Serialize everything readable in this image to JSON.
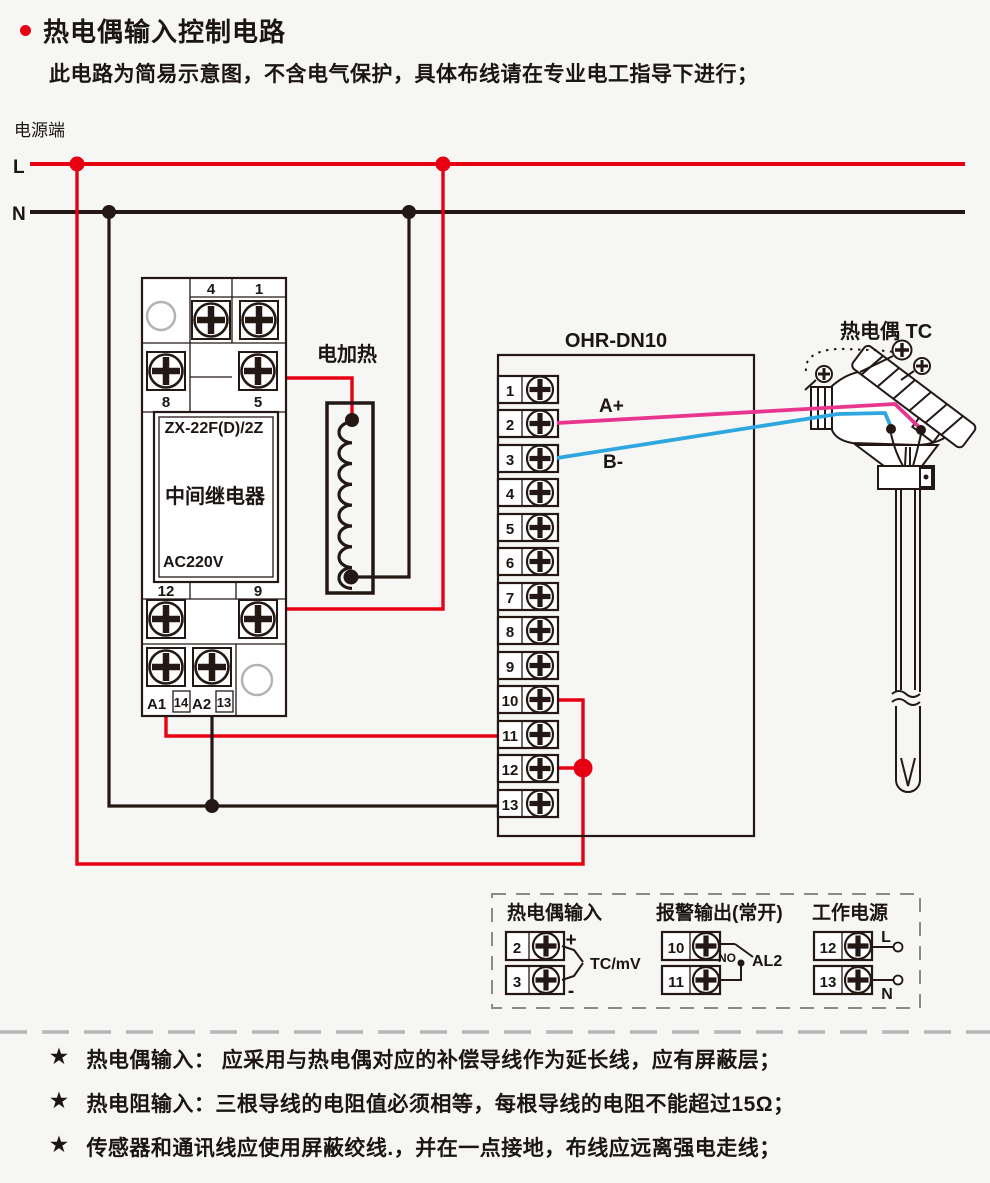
{
  "colors": {
    "line_red": "#e60012",
    "line_black": "#231815",
    "wire_pink": "#e8368f",
    "wire_blue": "#2ea7e0",
    "dash_gray": "#b5b5b6"
  },
  "header": {
    "title": "热电偶输入控制电路",
    "subtitle": "此电路为简易示意图，不含电气保护，具体布线请在专业电工指导下进行；"
  },
  "power": {
    "label": "电源端",
    "live": "L",
    "neutral": "N"
  },
  "relay": {
    "model": "ZX-22F(D)/2Z",
    "name": "中间继电器",
    "voltage": "AC220V",
    "top_terminals": [
      "4",
      "1"
    ],
    "row2_terminals": [
      "8",
      "5"
    ],
    "mid_terminals": [
      "12",
      "9"
    ],
    "coil_terminals": [
      "A1",
      "14",
      "A2",
      "13"
    ]
  },
  "heater": {
    "label": "电加热"
  },
  "controller": {
    "title": "OHR-DN10",
    "terminals": [
      "1",
      "2",
      "3",
      "4",
      "5",
      "6",
      "7",
      "8",
      "9",
      "10",
      "11",
      "12",
      "13"
    ],
    "a_plus": "A+",
    "b_minus": "B-"
  },
  "thermocouple": {
    "label": "热电偶 TC"
  },
  "legend": {
    "tc_input": {
      "title": "热电偶输入",
      "t2": "2",
      "t3": "3",
      "plus": "+",
      "minus": "-",
      "signal": "TC/mV"
    },
    "alarm": {
      "title": "报警输出(常开)",
      "t10": "10",
      "t11": "11",
      "no": "NO",
      "name": "AL2"
    },
    "supply": {
      "title": "工作电源",
      "t12": "12",
      "t13": "13",
      "live": "L",
      "neutral": "N"
    }
  },
  "notes": {
    "star": "★",
    "items": [
      "热电偶输入： 应采用与热电偶对应的补偿导线作为延长线，应有屏蔽层；",
      "热电阻输入：三根导线的电阻值必须相等，每根导线的电阻不能超过15Ω；",
      "传感器和通讯线应使用屏蔽绞线.，并在一点接地，布线应远离强电走线；"
    ]
  }
}
